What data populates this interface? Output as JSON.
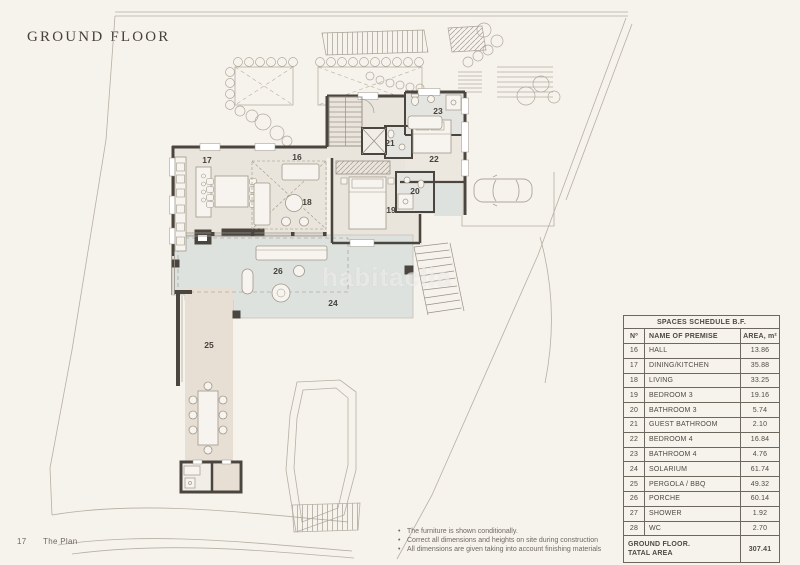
{
  "page": {
    "background": "#f6f2ec"
  },
  "header": {
    "title": "GROUND FLOOR"
  },
  "watermark": {
    "text": "habitaclia"
  },
  "plan": {
    "rooms": {
      "r16": "16",
      "r17": "17",
      "r18": "18",
      "r19": "19",
      "r20": "20",
      "r21": "21",
      "r22": "22",
      "r23": "23",
      "r24": "24",
      "r25": "25",
      "r26": "26"
    },
    "colors": {
      "wall": "#4a463f",
      "interior_floor": "#e9e4dc",
      "bathroom_floor": "#e4e5e1",
      "solarium": "#dee2df",
      "pergola": "#e7dfd4",
      "site_line": "#b7afa3"
    }
  },
  "schedule_table": {
    "title": "SPACES SCHEDULE B.F.",
    "columns": {
      "number": "Nº",
      "name": "NAME OF PREMISE",
      "area": "AREA, m²"
    },
    "rows": [
      {
        "n": "16",
        "name": "HALL",
        "area": "13.86"
      },
      {
        "n": "17",
        "name": "DINING/KITCHEN",
        "area": "35.88"
      },
      {
        "n": "18",
        "name": "LIVING",
        "area": "33.25"
      },
      {
        "n": "19",
        "name": "BEDROOM 3",
        "area": "19.16"
      },
      {
        "n": "20",
        "name": "BATHROOM 3",
        "area": "5.74"
      },
      {
        "n": "21",
        "name": "GUEST BATHROOM",
        "area": "2.10"
      },
      {
        "n": "22",
        "name": "BEDROOM 4",
        "area": "16.84"
      },
      {
        "n": "23",
        "name": "BATHROOM 4",
        "area": "4.76"
      },
      {
        "n": "24",
        "name": "SOLARIUM",
        "area": "61.74"
      },
      {
        "n": "25",
        "name": "PERGOLA / BBQ",
        "area": "49.32"
      },
      {
        "n": "26",
        "name": "PORCHE",
        "area": "60.14"
      },
      {
        "n": "27",
        "name": "SHOWER",
        "area": "1.92"
      },
      {
        "n": "28",
        "name": "WC",
        "area": "2.70"
      }
    ],
    "total": {
      "label_line1": "GROUND FLOOR.",
      "label_line2": "TATAL AREA",
      "value": "307.41"
    }
  },
  "notes": {
    "items": [
      "The furniture is shown conditionally.",
      "Correct all dimensions and heights on site during construction",
      "All dimensions are given taking into account finishing materials"
    ]
  },
  "footer": {
    "page_number": "17",
    "label": "The Plan"
  }
}
